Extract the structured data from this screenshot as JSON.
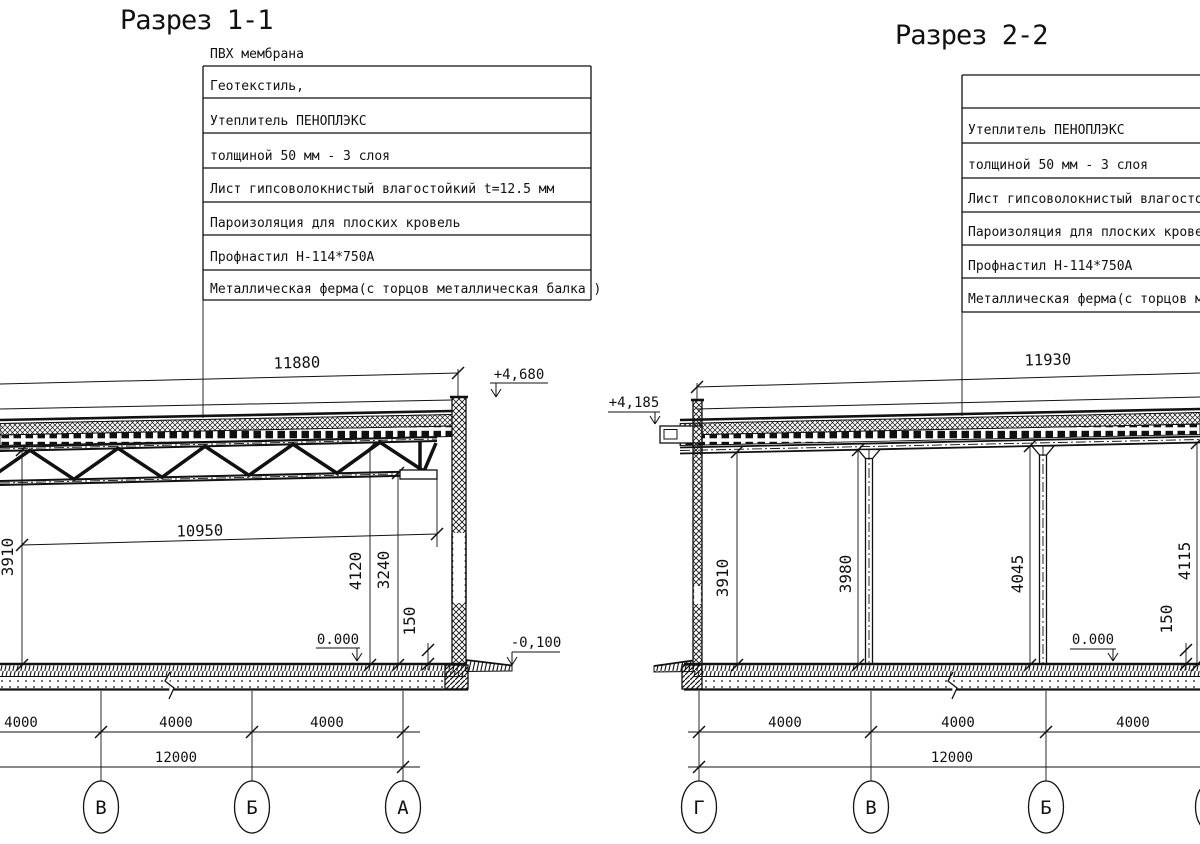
{
  "colors": {
    "ink": "#111111",
    "paper": "#ffffff"
  },
  "left_section": {
    "title": "Разрез 1-1",
    "membrane_label": "ПВХ мембрана",
    "callout_rows": [
      "Геотекстиль,",
      "Утеплитель ПЕНОПЛЭКС",
      "толщиной 50 мм - 3 слоя",
      "Лист гипсоволокнистый влагостойкий t=12.5 мм",
      "Пароизоляция для плоских кровель",
      "Профнастил Н-114*750А",
      "Металлическая ферма(с торцов металлическая балка )"
    ],
    "dims": {
      "span_top": "11880",
      "span_chord": "10950",
      "height_left": "3910",
      "height_top": "4120",
      "height_chord": "3240",
      "slab": "150"
    },
    "levels": {
      "roof": "+4,680",
      "floor": "0.000",
      "grade": "-0,100"
    },
    "bottom_dims": [
      "4000",
      "4000",
      "4000"
    ],
    "total_dim": "12000",
    "axes": [
      "В",
      "Б",
      "А"
    ]
  },
  "right_section": {
    "title": "Разрез 2-2",
    "callout_rows": [
      "",
      "Утеплитель ПЕНОПЛЭКС",
      "толщиной 50 мм - 3 слоя",
      "Лист гипсоволокнистый влагостойкий t=12.5 мм",
      "Пароизоляция для плоских кровель",
      "Профнастил Н-114*750А",
      "Металлическая ферма(с торцов металлическая балка )"
    ],
    "dims": {
      "height_1": "3910",
      "height_2": "3980",
      "height_3": "4045",
      "height_4": "4115",
      "span_top": "11930",
      "slab": "150"
    },
    "levels": {
      "roof": "+4,185",
      "floor": "0.000"
    },
    "bottom_dims": [
      "4000",
      "4000",
      "4000"
    ],
    "total_dim": "12000",
    "axes": [
      "Г",
      "В",
      "Б",
      "А"
    ]
  }
}
